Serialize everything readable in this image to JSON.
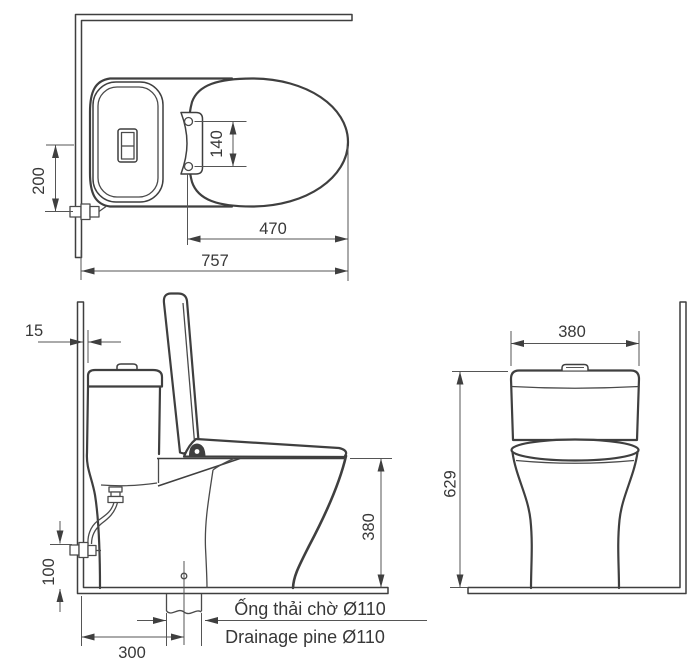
{
  "background": "#ffffff",
  "line_color": "#3f3f3f",
  "top_view": {
    "supply_offset": "200",
    "hinge_spacing": "140",
    "bowl_length": "470",
    "total_depth": "757"
  },
  "side_view": {
    "wall_gap": "15",
    "rim_height": "380",
    "supply_height": "100",
    "drain_setout": "300",
    "drain_note_vi": "Ống thải chờ Ø110",
    "drain_note_en": "Drainage pine Ø110"
  },
  "front_view": {
    "tank_width": "380",
    "overall_height": "629"
  }
}
